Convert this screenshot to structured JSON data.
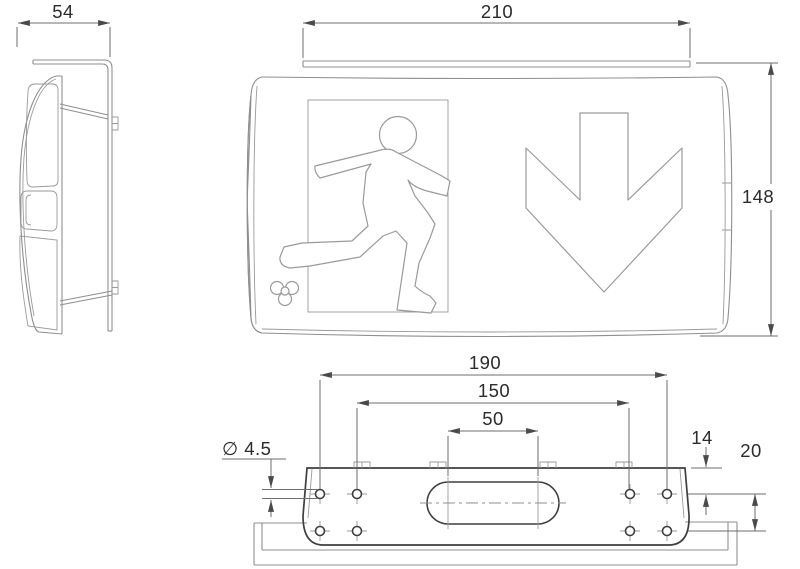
{
  "drawing": {
    "kind": "technical-dimension-drawing",
    "product": "emergency exit sign luminaire with ceiling mounting bracket",
    "views": [
      {
        "id": "side",
        "label": "side profile view"
      },
      {
        "id": "front",
        "label": "front view with exit pictograms"
      },
      {
        "id": "bottom",
        "label": "bottom view of mounting bracket"
      }
    ],
    "pictograms": {
      "running_man": "running man exit symbol in doorway",
      "down_arrow": "downward direction arrow",
      "logo_mark": "four-circle logo mark"
    },
    "colors": {
      "background": "#ffffff",
      "outline": "#8f8f8f",
      "outline_dark": "#3f3f3f",
      "dimension_line": "#6e6e6e",
      "text": "#2b2b2b"
    }
  },
  "dimensions": {
    "side_depth_mm": "54",
    "front_width_mm": "210",
    "front_height_mm": "148",
    "bracket_outer_span_mm": "190",
    "bracket_inner_span_mm": "150",
    "slot_center_span_mm": "50",
    "hole_diameter_label": "∅ 4.5",
    "hole_top_offset_mm": "14",
    "hole_row_gap_mm": "20"
  }
}
